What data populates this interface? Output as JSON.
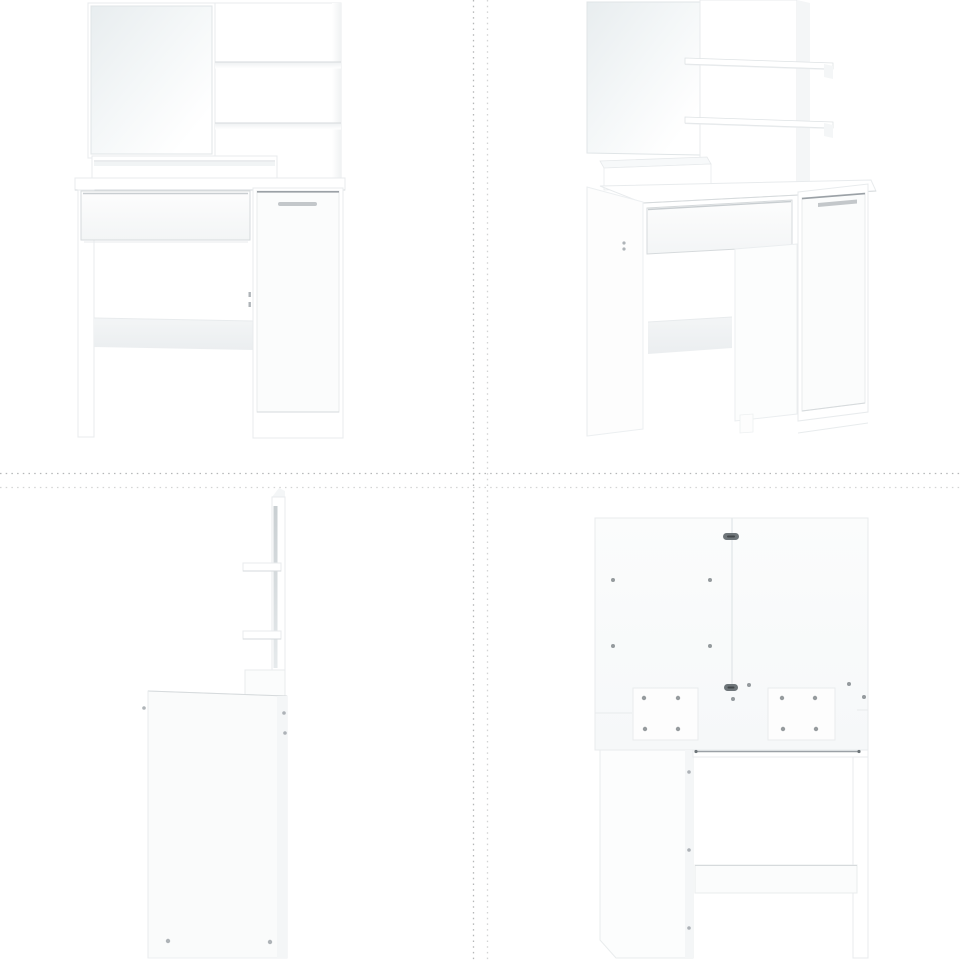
{
  "page": {
    "type": "product-image-grid",
    "description": "Four product photos of a white dressing table with mirror, shelves, drawer and cabinet, arranged in a 2x2 grid separated by dashed lines"
  },
  "views": [
    {
      "id": "front",
      "label": "White dressing table with mirror - front view",
      "position": "top-left"
    },
    {
      "id": "angled",
      "label": "White dressing table with mirror - angled view",
      "position": "top-right"
    },
    {
      "id": "side",
      "label": "White dressing table with mirror - side view",
      "position": "bottom-left"
    },
    {
      "id": "back",
      "label": "White dressing table with mirror - back view",
      "position": "bottom-right"
    }
  ],
  "grid": {
    "rows": 2,
    "cols": 2,
    "divider_x": [
      473,
      487
    ],
    "divider_y": [
      473,
      487
    ]
  },
  "colors": {
    "background": "#ffffff",
    "divider": "#b5b7b8",
    "furniture_white": "#ffffff",
    "panel_tint": "#f4f6f7",
    "edge_light": "#e8ebed",
    "edge_mid": "#d6dadc",
    "edge_dark": "#9ba1a6",
    "handle": "#c3c7ca",
    "hardware_dark": "#6e7579",
    "mirror_tint": "#e8edef",
    "shadow_tint": "#eff1f2"
  }
}
